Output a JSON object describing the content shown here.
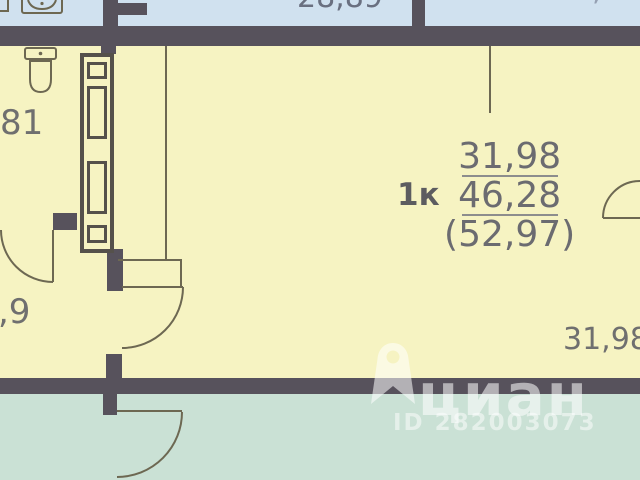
{
  "canvas": {
    "width": 640,
    "height": 480
  },
  "colors": {
    "room_fill": "#f6f3c2",
    "neighbor_top_fill": "#d0e1ef",
    "neighbor_bottom_fill": "#cae1d5",
    "wall": "#57525c",
    "thin_line": "#6d6852",
    "dimension_text": "#6f6f6f",
    "watermark_text": "rgba(255,255,255,0.55)"
  },
  "unit": {
    "type_label": "1к",
    "living_area": "31,98",
    "total_area": "46,28",
    "overall_area": "(52,97)"
  },
  "dimensions": {
    "top_clipped": "28,89",
    "top_right_clipped": ",",
    "left_upper_clipped": "81",
    "left_lower_clipped": ",9",
    "bottom_right": "31,98"
  },
  "watermark": {
    "brand": "циан",
    "listing_id": "ID 282003073"
  },
  "icons": [
    {
      "name": "toilet-icon"
    },
    {
      "name": "washing-machine-icon"
    },
    {
      "name": "vent-shaft-symbol"
    },
    {
      "name": "cian-pin-icon"
    },
    {
      "name": "door-swing-arc"
    }
  ]
}
